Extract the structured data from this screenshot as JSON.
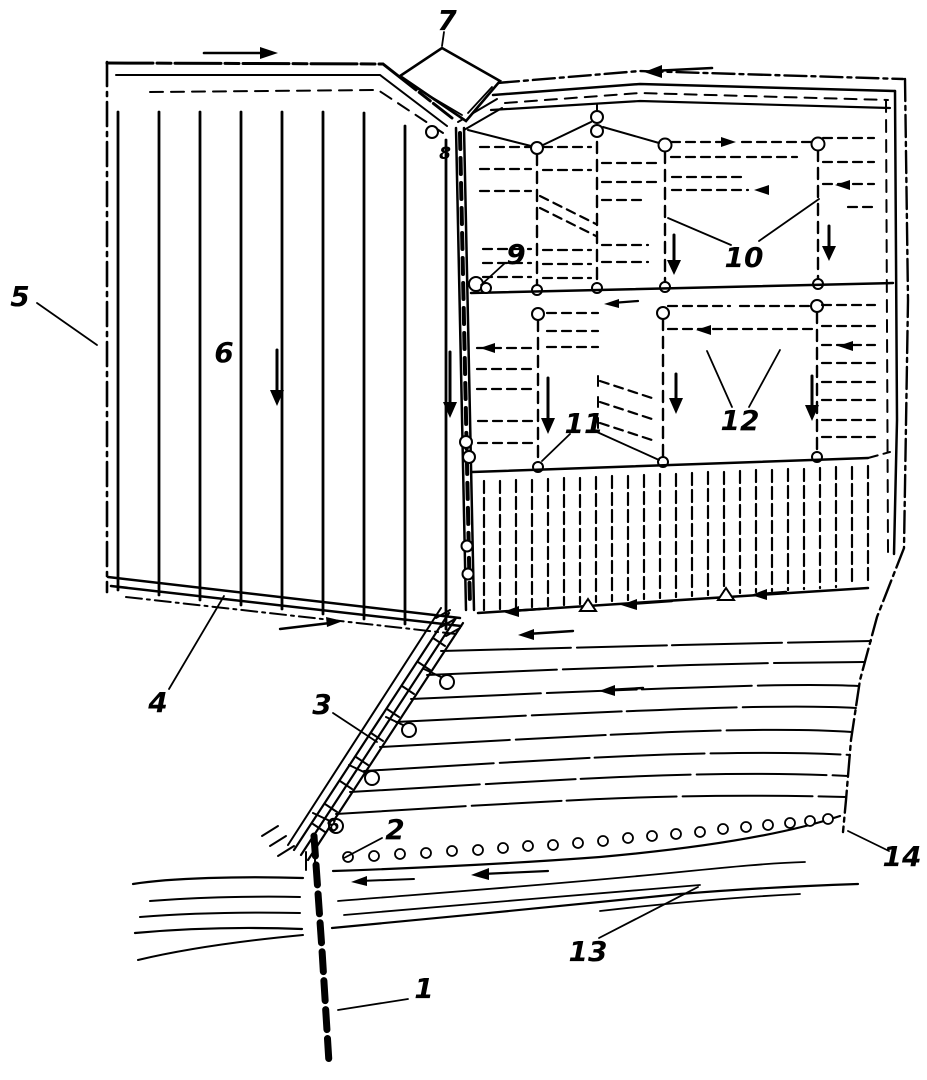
{
  "figure": {
    "background": "#ffffff",
    "ink": "#000000",
    "labels": [
      "1",
      "2",
      "3",
      "4",
      "5",
      "6",
      "7",
      "8",
      "9",
      "10",
      "11",
      "12",
      "13",
      "14"
    ]
  }
}
